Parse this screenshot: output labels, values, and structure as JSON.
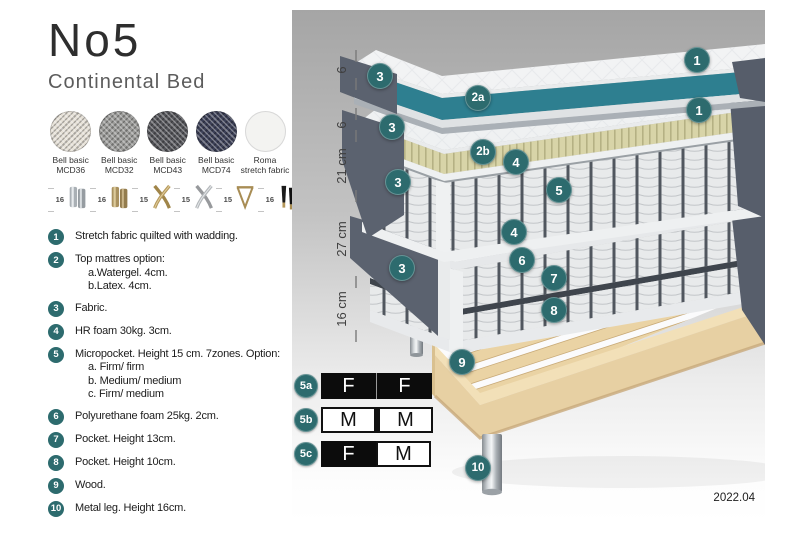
{
  "header": {
    "title": "No5",
    "subtitle": "Continental Bed"
  },
  "fabrics": [
    {
      "line1": "Bell basic",
      "line2": "MCD36",
      "color": "#e6e1d7"
    },
    {
      "line1": "Bell basic",
      "line2": "MCD32",
      "color": "#9b9b99"
    },
    {
      "line1": "Bell basic",
      "line2": "MCD43",
      "color": "#54555a"
    },
    {
      "line1": "Bell basic",
      "line2": "MCD74",
      "color": "#3c4057"
    },
    {
      "line1": "Roma",
      "line2": "stretch fabric",
      "color": "#f3f3f1"
    }
  ],
  "legs": [
    {
      "height": "16",
      "type": "chrome-cylinder-legs"
    },
    {
      "height": "16",
      "type": "brass-cylinder-legs"
    },
    {
      "height": "15",
      "type": "gold-cross-legs"
    },
    {
      "height": "15",
      "type": "silver-cross-legs"
    },
    {
      "height": "15",
      "type": "hairpin-legs"
    },
    {
      "height": "16",
      "type": "black-tapered-legs-brass-tip"
    }
  ],
  "list": [
    {
      "num": "1",
      "text": "Stretch fabric quilted with wadding."
    },
    {
      "num": "2",
      "text": "Top mattres option:",
      "sub": [
        "a.Watergel. 4cm.",
        "b.Latex. 4cm."
      ]
    },
    {
      "num": "3",
      "text": "Fabric."
    },
    {
      "num": "4",
      "text": "HR foam 30kg. 3cm."
    },
    {
      "num": "5",
      "text": "Micropocket. Height 15 cm. 7zones. Option:",
      "sub": [
        "a. Firm/ firm",
        "b. Medium/ medium",
        "c. Firm/ medium"
      ]
    },
    {
      "num": "6",
      "text": "Polyurethane foam 25kg. 2cm."
    },
    {
      "num": "7",
      "text": "Pocket. Height 13cm."
    },
    {
      "num": "8",
      "text": "Pocket. Height 10cm."
    },
    {
      "num": "9",
      "text": "Wood."
    },
    {
      "num": "10",
      "text": "Metal leg. Height 16cm."
    }
  ],
  "diagram": {
    "ruler": [
      "6",
      "6",
      "21 cm",
      "27 cm",
      "16 cm"
    ],
    "callouts": [
      "1",
      "2a",
      "3",
      "1",
      "2b",
      "3",
      "4",
      "5",
      "3",
      "4",
      "6",
      "7",
      "3",
      "8",
      "9",
      "10"
    ],
    "version": "2022.04"
  },
  "firmness_table": {
    "rows": [
      {
        "label": "5a",
        "cells": [
          {
            "text": "F",
            "style": "dark"
          },
          {
            "text": "F",
            "style": "dark"
          }
        ]
      },
      {
        "label": "5b",
        "cells": [
          {
            "text": "M",
            "style": "light"
          },
          {
            "text": "M",
            "style": "light"
          }
        ]
      },
      {
        "label": "5c",
        "cells": [
          {
            "text": "F",
            "style": "dark"
          },
          {
            "text": "M",
            "style": "light"
          }
        ]
      }
    ]
  },
  "colors": {
    "callout_teal": "#2d6b6e",
    "watergel_teal": "#2e7f90",
    "latex_beige": "#d8d4a8",
    "bed_fabric_gray": "#5b626f",
    "wood": "#e7d0a3",
    "panel_gradient_top": "#a5a5a5"
  }
}
